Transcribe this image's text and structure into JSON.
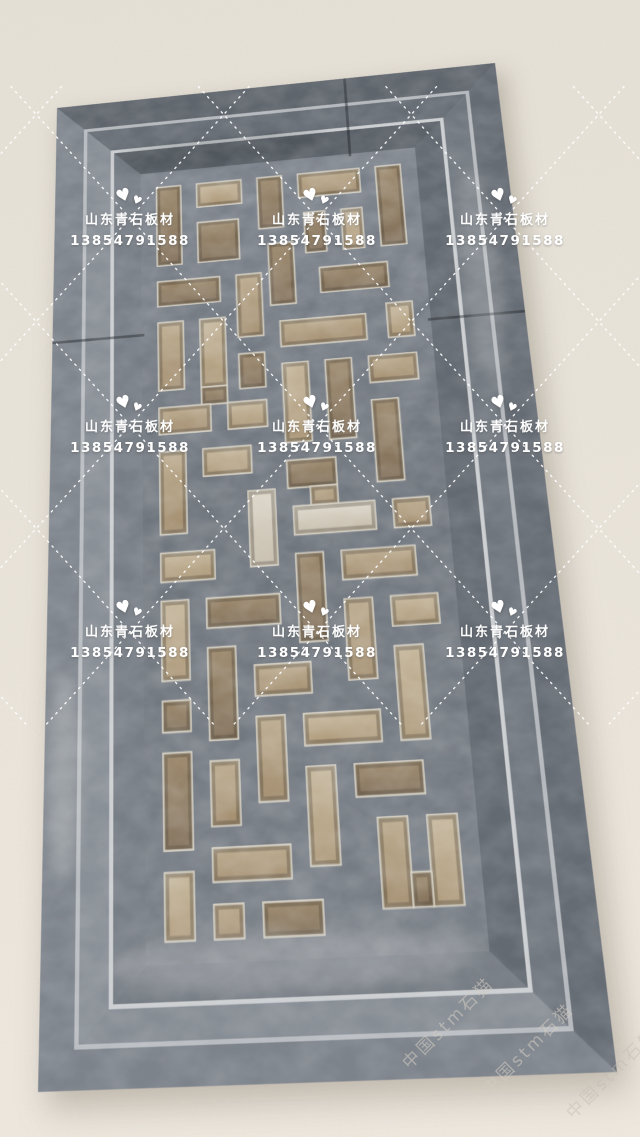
{
  "watermark": {
    "logo_icon": "double-heart-logo-icon",
    "logo_glyph": "♥",
    "brand_line": "山东青石板材",
    "phone_line": "13854791588",
    "text_color": "#ffffff",
    "grid_style": "dotted-diamond-lattice",
    "positions": {
      "columns_x": [
        130,
        317,
        505
      ],
      "rows_y": [
        185,
        392,
        597
      ]
    }
  },
  "corner_watermark": {
    "text": "中国stm石猫",
    "color": "#cdc8be",
    "angle_deg": -45
  },
  "palette": {
    "wall_top": "#e6e1d7",
    "wall_bottom": "#efe9e0",
    "stone_base": "#6e747c",
    "stone_light": "#9aa0a6",
    "stone_dark": "#555b63",
    "ridge_highlight": "#ced2d5",
    "opening_tan": "#b29c80",
    "opening_tan_light": "#c2b49a",
    "opening_tan_dark": "#937f63",
    "opening_bright": "#ded8cb",
    "hole_rim": "#d8d2c4"
  }
}
